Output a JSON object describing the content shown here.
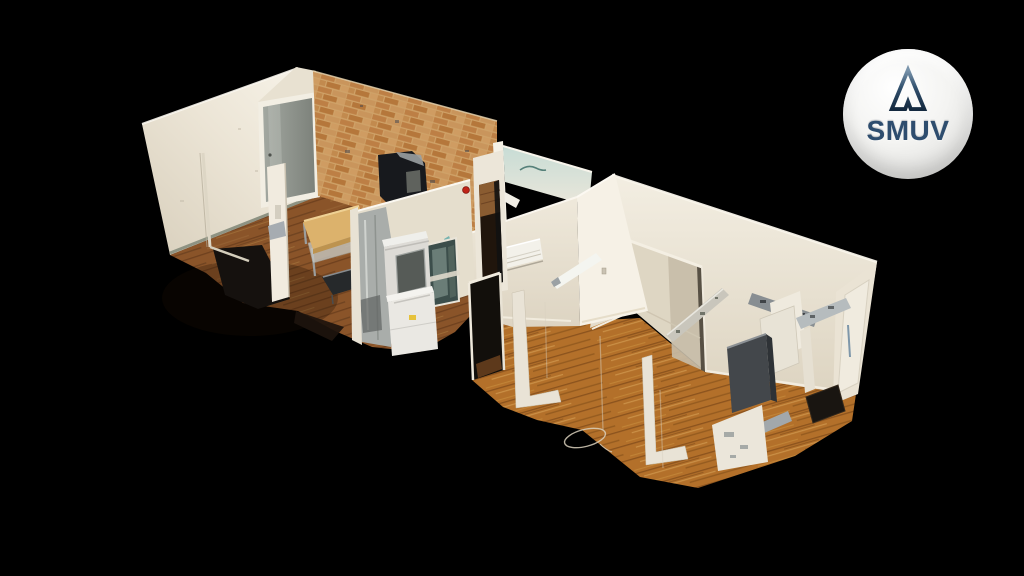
{
  "logo_badge": {
    "brand_name": "SMUV",
    "icon": "triangle-delta-logo-icon",
    "shape": "glossy-white-circle"
  },
  "scene": {
    "type": "3d-dollhouse-tour-view",
    "description": "Isometric cutaway 3D scan of an apartment on a black void: left room with exposed brick wall, gray entry door, work table and black cabinet; middle laundry closet with stacked washer-dryer, furnace and window; right rooms with warm wood floors, wall AC unit, doorway openings, kitchen appliances and scan artifacts",
    "objects": [
      "left-room",
      "left-wall",
      "entry-door",
      "brick-wall",
      "work-table",
      "black-cabinet",
      "white-column",
      "area-rug",
      "laundry-closet",
      "washer-dryer-stack",
      "furnace",
      "closet-window",
      "fire-alarm",
      "bathroom-wall",
      "right-room-floor",
      "back-wall",
      "back-wall-doorway",
      "partition-wall",
      "ac-unit",
      "kitchen-appliances",
      "right-end-door",
      "floor-scan-marker",
      "scan-artifact-strips"
    ]
  },
  "colors": {
    "background": "#000000",
    "wall_bright": "#f6f1e7",
    "wall_cream": "#e8e1d1",
    "wall_shadow": "#d8cfbc",
    "floor_left": "#8a5429",
    "floor_right": "#b3702a",
    "brick_base": "#cfa268",
    "brick_dark": "#b5773b",
    "door_gray": "#8f938c",
    "teal_tint": "#c7dcd5",
    "alarm_red": "#c02418",
    "logo_navy": "#2e4d6e",
    "badge_white": "#f2f2f0"
  }
}
